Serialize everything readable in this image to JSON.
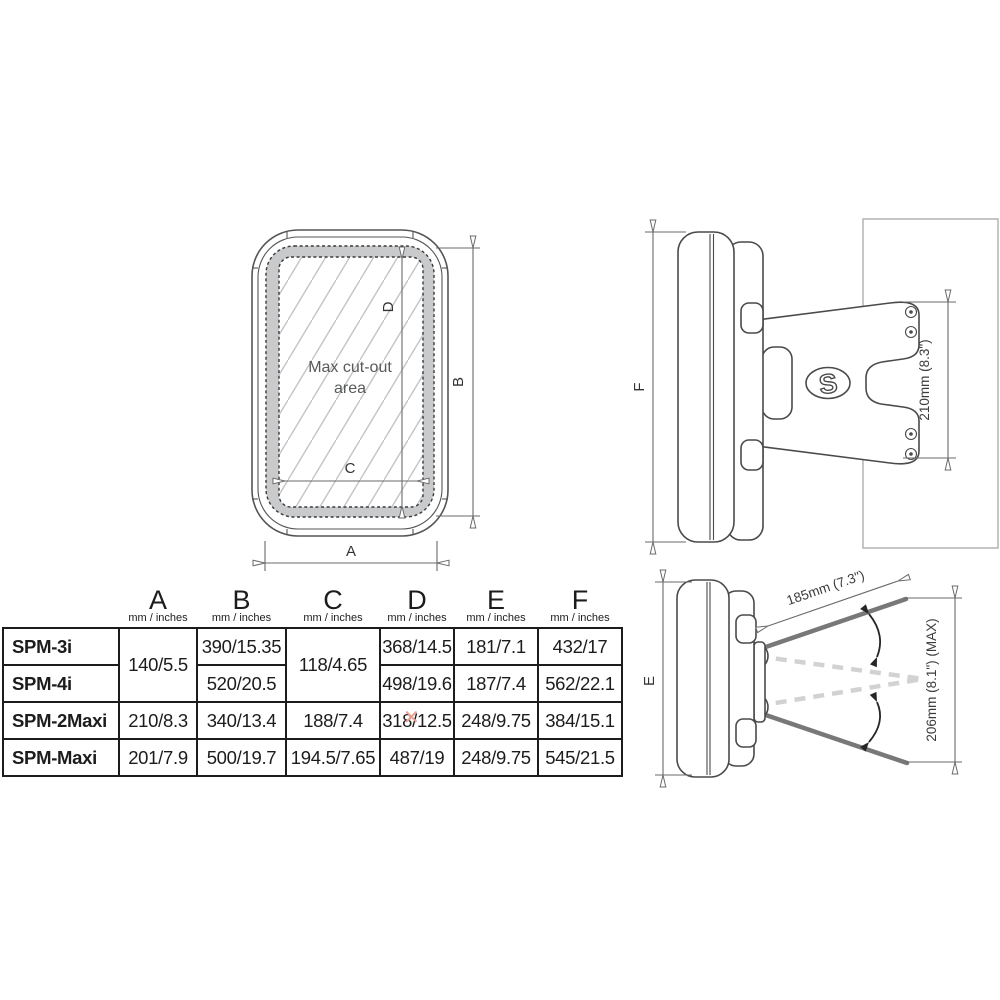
{
  "front_view": {
    "cutout_line1": "Max cut-out",
    "cutout_line2": "area",
    "label_a": "A",
    "label_b": "B",
    "label_c": "C",
    "label_d": "D"
  },
  "side_view": {
    "label_f": "F",
    "bracket_dim": "210mm (8.3\")",
    "logo_letter": "S"
  },
  "tilt_view": {
    "label_e": "E",
    "arm_dim": "185mm (7.3\")",
    "max_dim": "206mm (8.1\") (MAX)"
  },
  "table": {
    "columns": [
      {
        "letter": "A",
        "unit": "mm / inches"
      },
      {
        "letter": "B",
        "unit": "mm / inches"
      },
      {
        "letter": "C",
        "unit": "mm / inches"
      },
      {
        "letter": "D",
        "unit": "mm / inches"
      },
      {
        "letter": "E",
        "unit": "mm / inches"
      },
      {
        "letter": "F",
        "unit": "mm / inches"
      }
    ],
    "rows": [
      {
        "name": "SPM-3i",
        "a": "140/5.5",
        "b": "390/15.35",
        "c": "118/4.65",
        "d": "368/14.5",
        "e": "181/7.1",
        "f": "432/17"
      },
      {
        "name": "SPM-4i",
        "b": "520/20.5",
        "d": "498/19.6",
        "e": "187/7.4",
        "f": "562/22.1"
      },
      {
        "name": "SPM-2Maxi",
        "a": "210/8.3",
        "b": "340/13.4",
        "c": "188/7.4",
        "d": "318/12.5",
        "e": "248/9.75",
        "f": "384/15.1"
      },
      {
        "name": "SPM-Maxi",
        "a": "201/7.9",
        "b": "500/19.7",
        "c": "194.5/7.65",
        "d": "487/19",
        "e": "248/9.75",
        "f": "545/21.5"
      }
    ]
  },
  "artifact_x": "✕",
  "colors": {
    "line_dark": "#4a4a4a",
    "dimension_gray": "#6a6a6a",
    "bezel_gray": "#c9cacb",
    "hatch_gray": "#c4c4c4",
    "panel_gray": "#b3b3b3",
    "arm_gray": "#787878",
    "ghost_gray": "#d2d2d2",
    "text_gray": "#58595b",
    "table_black": "#1c1c1c",
    "artifact_salmon": "#eda092"
  }
}
